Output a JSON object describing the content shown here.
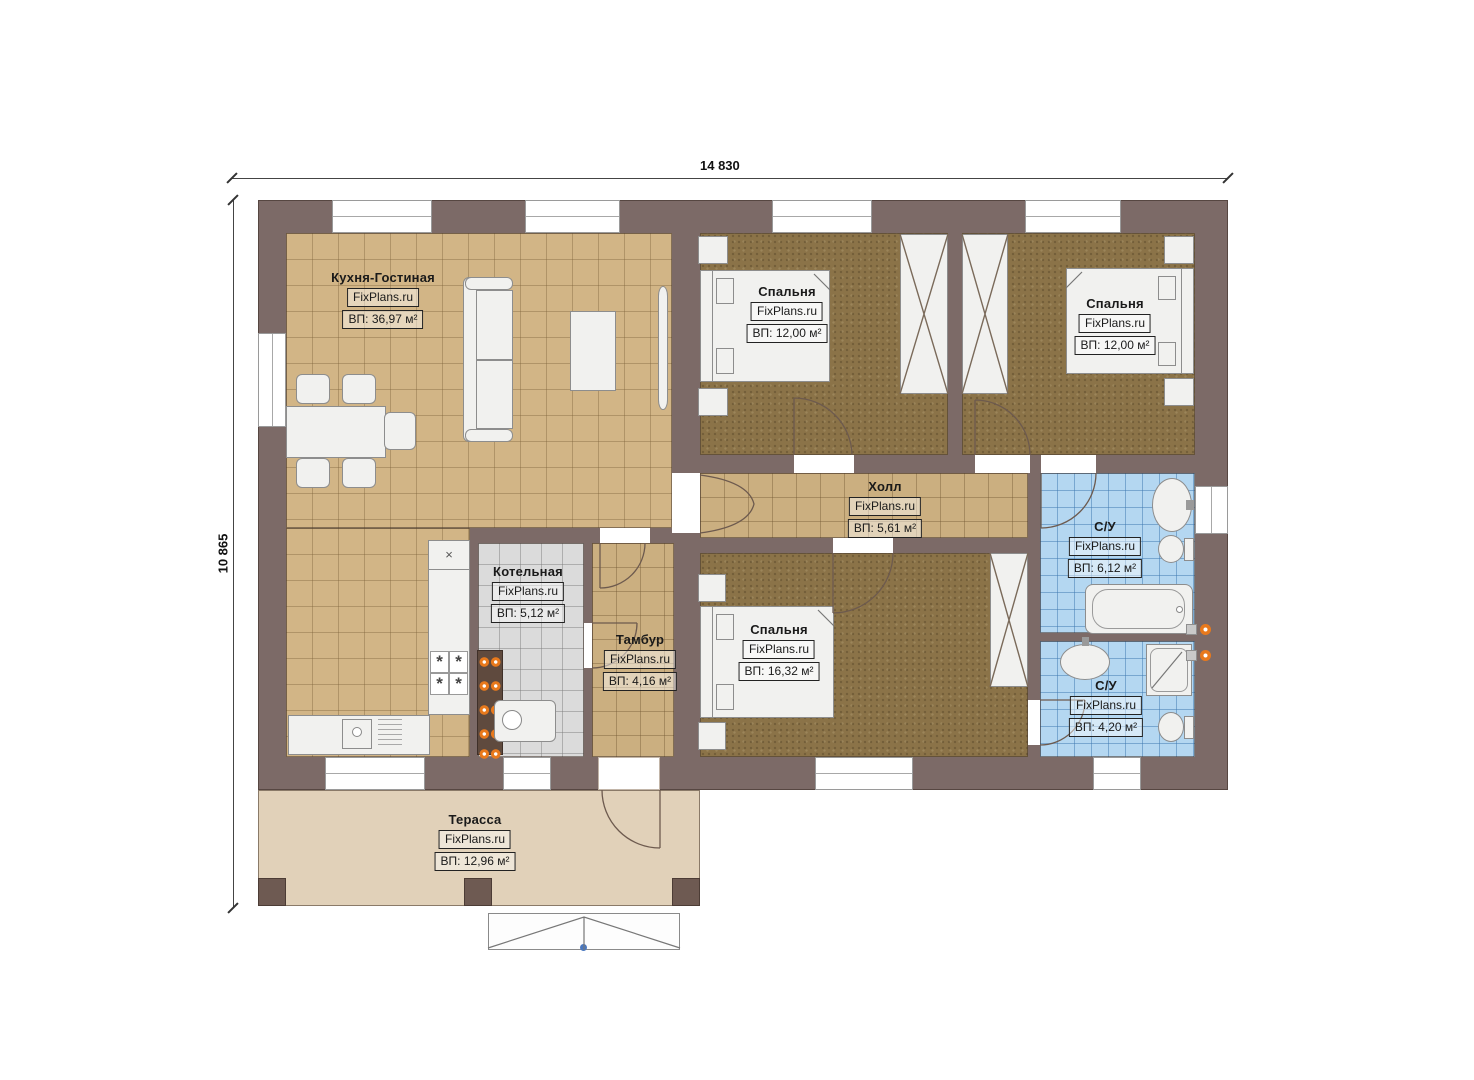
{
  "dimensions": {
    "width_mm": "14 830",
    "height_mm": "10 865"
  },
  "watermark": "FixPlans.ru",
  "rooms": [
    {
      "key": "kitchen-living",
      "name": "Кухня-Гостиная",
      "brand": "FixPlans.ru",
      "area": "ВП: 36,97 м²"
    },
    {
      "key": "bedroom-1",
      "name": "Спальня",
      "brand": "FixPlans.ru",
      "area": "ВП: 12,00 м²"
    },
    {
      "key": "bedroom-2",
      "name": "Спальня",
      "brand": "FixPlans.ru",
      "area": "ВП: 12,00 м²"
    },
    {
      "key": "hall",
      "name": "Холл",
      "brand": "FixPlans.ru",
      "area": "ВП: 5,61 м²"
    },
    {
      "key": "boiler-room",
      "name": "Котельная",
      "brand": "FixPlans.ru",
      "area": "ВП: 5,12 м²"
    },
    {
      "key": "vestibule",
      "name": "Тамбур",
      "brand": "FixPlans.ru",
      "area": "ВП: 4,16 м²"
    },
    {
      "key": "bedroom-3",
      "name": "Спальня",
      "brand": "FixPlans.ru",
      "area": "ВП: 16,32 м²"
    },
    {
      "key": "bathroom-1",
      "name": "С/У",
      "brand": "FixPlans.ru",
      "area": "ВП: 6,12 м²"
    },
    {
      "key": "bathroom-2",
      "name": "С/У",
      "brand": "FixPlans.ru",
      "area": "ВП: 4,20 м²"
    },
    {
      "key": "terrace",
      "name": "Терасса",
      "brand": "FixPlans.ru",
      "area": "ВП: 12,96 м²"
    }
  ],
  "symbols": {
    "cabinet_cross": "×",
    "burner": "*"
  },
  "colors": {
    "wall": "#7c6a67",
    "tile_tan": "#d2b586",
    "carpet_brown": "#8b7348",
    "tile_blue": "#b4d7f1",
    "tile_gray": "#dbdbdb",
    "terrace": "#e1d1b9",
    "accent_orange": "#e8791c"
  }
}
